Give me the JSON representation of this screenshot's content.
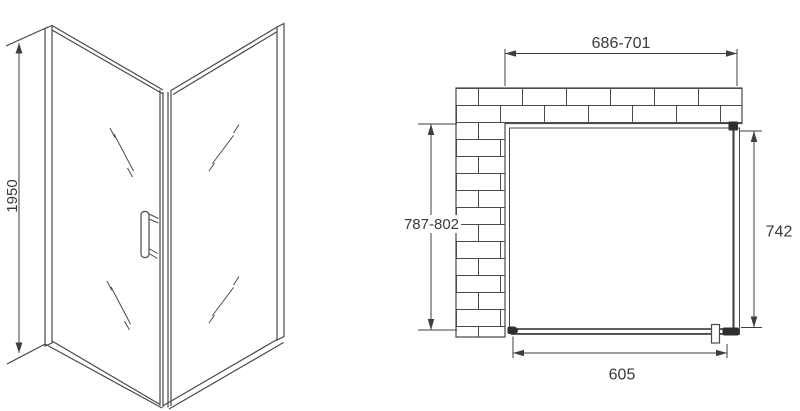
{
  "colors": {
    "line": "#4a4a4a",
    "dim_line": "#3f3f3f",
    "text": "#3a3a3a",
    "dark_fill": "#2e2e2e",
    "background": "#ffffff"
  },
  "front_view": {
    "height_dimension": {
      "label": "1950"
    }
  },
  "plan_view": {
    "width_dimension": {
      "label": "686-701"
    },
    "depth_dimension": {
      "label": "787-802"
    },
    "side_panel_dimension": {
      "label": "742"
    },
    "door_dimension": {
      "label": "605"
    }
  }
}
